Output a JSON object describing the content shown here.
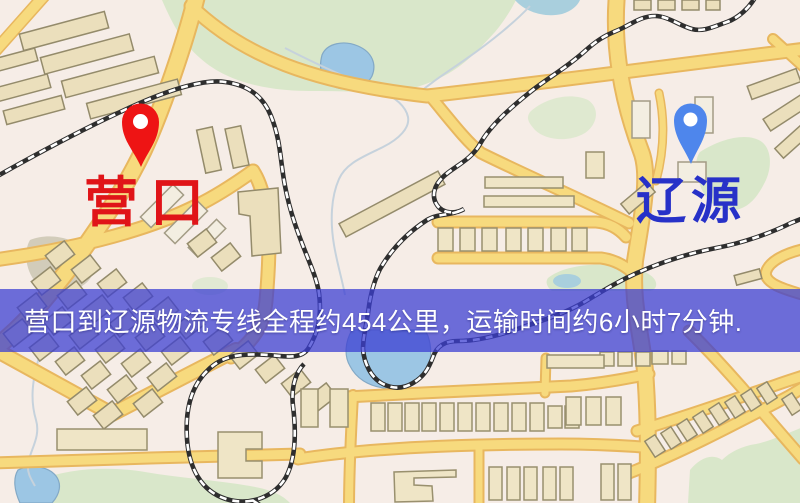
{
  "map": {
    "banner": {
      "text": "营口到辽源物流专线全程约454公里，运输时间约6小时7分钟."
    },
    "route": {
      "origin": "营口",
      "destination": "辽源",
      "distance_text": "约454公里",
      "duration_text": "约6小时7分钟"
    },
    "markers": [
      {
        "id": "origin",
        "label": "营口",
        "pin_color": "#EE1414",
        "label_color": "#E01418"
      },
      {
        "id": "destination",
        "label": "辽源",
        "pin_color": "#4E86EC",
        "label_color": "#2731C8"
      }
    ],
    "colors": {
      "banner_overlay": "#3C3ED2",
      "banner_text": "#FFFFFF",
      "road_fill": "#F7DA7E",
      "road_casing": "#E8B75F",
      "park": "#D9E7CA",
      "water": "#9CC6E4",
      "building": "#EBDFBC",
      "railway_dark": "#2E2E2E",
      "map_background": "#F6EDE7"
    }
  }
}
